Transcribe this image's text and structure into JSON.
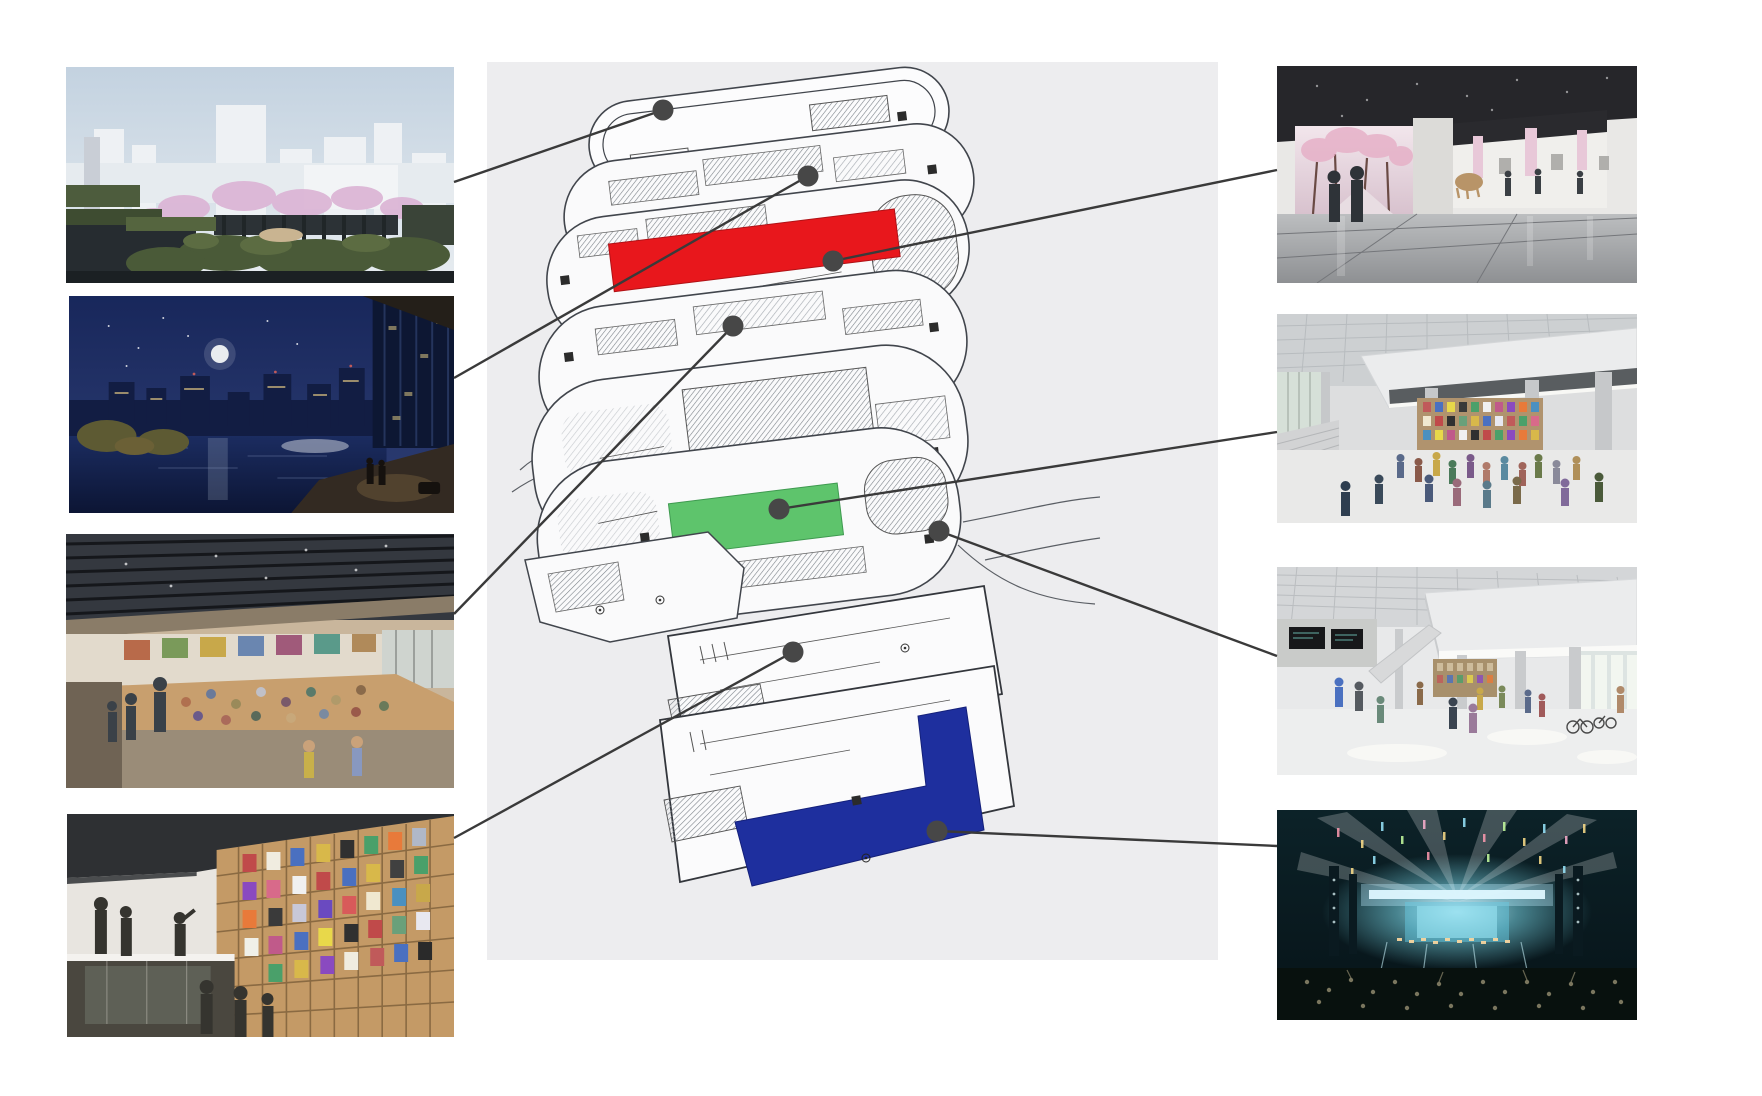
{
  "canvas": {
    "width": 1762,
    "height": 1096,
    "background": "#ffffff"
  },
  "diagram": {
    "type": "exploded-floor-stack",
    "panel": {
      "x": 487,
      "y": 62,
      "width": 731,
      "height": 898,
      "color": "#ededef"
    },
    "line_color": "#3a3a3a",
    "line_width": 2.4,
    "marker_color": "#474747",
    "marker_radius": 10.5,
    "plate_fill": "#fafafa",
    "plate_stroke": "#41454c",
    "highlights": {
      "red": {
        "color": "#e8171c",
        "position": "upper-floor-band"
      },
      "green": {
        "color": "#5ec46c",
        "position": "mid-floor-band"
      },
      "blue": {
        "color": "#1e2f9e",
        "position": "lower-floor-L"
      }
    },
    "floor_count": 9
  },
  "connectors": [
    {
      "id": "rooftop-garden",
      "x1": 454,
      "y1": 182,
      "x2": 663,
      "y2": 110,
      "dot": {
        "x": 663,
        "y": 110
      }
    },
    {
      "id": "night-terrace",
      "x1": 454,
      "y1": 378,
      "x2": 808,
      "y2": 176,
      "dot": {
        "x": 808,
        "y": 176
      }
    },
    {
      "id": "event-platform",
      "x1": 454,
      "y1": 614,
      "x2": 733,
      "y2": 326,
      "dot": {
        "x": 733,
        "y": 326
      }
    },
    {
      "id": "manga-library",
      "x1": 454,
      "y1": 838,
      "x2": 793,
      "y2": 652,
      "dot": {
        "x": 793,
        "y": 652
      }
    },
    {
      "id": "art-gallery",
      "x1": 1277,
      "y1": 170,
      "x2": 833,
      "y2": 261,
      "dot": {
        "x": 833,
        "y": 261
      }
    },
    {
      "id": "event-hall",
      "x1": 1277,
      "y1": 432,
      "x2": 779,
      "y2": 509,
      "dot": {
        "x": 779,
        "y": 509
      }
    },
    {
      "id": "atrium",
      "x1": 1277,
      "y1": 656,
      "x2": 939,
      "y2": 531,
      "dot": {
        "x": 939,
        "y": 531
      }
    },
    {
      "id": "concert-hall",
      "x1": 1277,
      "y1": 846,
      "x2": 937,
      "y2": 831,
      "dot": {
        "x": 937,
        "y": 831
      }
    }
  ],
  "photos": [
    {
      "id": "rooftop-garden",
      "side": "left",
      "x": 66,
      "y": 67,
      "width": 388,
      "height": 216,
      "description": "Rooftop garden promenade with cherry blossoms and white city skyline"
    },
    {
      "id": "night-terrace",
      "side": "left",
      "x": 69,
      "y": 296,
      "width": 385,
      "height": 217,
      "description": "Night waterside terrace with full moon, city lights and lit tower"
    },
    {
      "id": "event-platform",
      "side": "left",
      "x": 66,
      "y": 534,
      "width": 388,
      "height": 254,
      "description": "Hall with slatted ceiling and people seated on a large wooden platform"
    },
    {
      "id": "manga-library",
      "side": "left",
      "x": 67,
      "y": 814,
      "width": 387,
      "height": 223,
      "description": "Tall wooden bookshelf wall filled with manga art, visitors below"
    },
    {
      "id": "art-gallery",
      "side": "right",
      "x": 1277,
      "y": 66,
      "width": 360,
      "height": 217,
      "description": "Gallery with dark coffered ceiling, cherry-blossom projection wall and exhibits"
    },
    {
      "id": "event-hall",
      "side": "right",
      "x": 1277,
      "y": 314,
      "width": 360,
      "height": 209,
      "description": "Event hall with white canopy, bookshelf wall and gathered crowd"
    },
    {
      "id": "atrium",
      "side": "right",
      "x": 1277,
      "y": 567,
      "width": 360,
      "height": 208,
      "description": "Daylit atrium lobby with grid ceiling, columns, visitors and bicycles"
    },
    {
      "id": "concert-hall",
      "side": "right",
      "x": 1277,
      "y": 810,
      "width": 360,
      "height": 210,
      "description": "Concert arena with bright stage lights and audience"
    }
  ]
}
